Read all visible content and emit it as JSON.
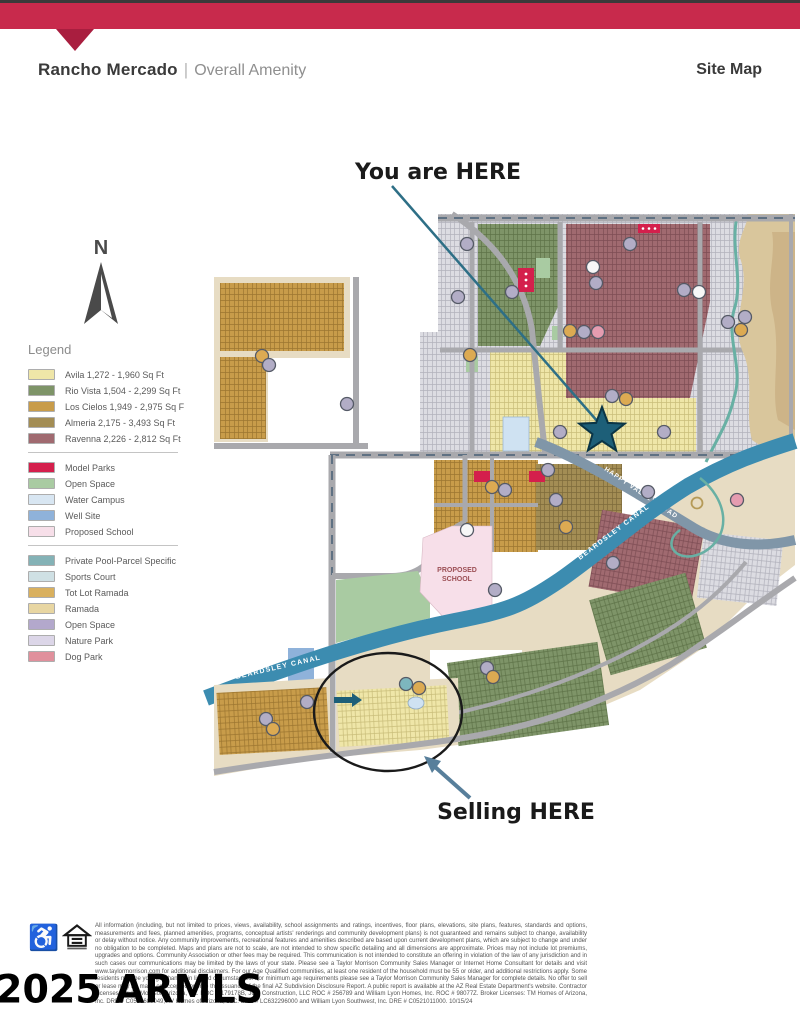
{
  "header": {
    "title": "Rancho Mercado",
    "separator": "|",
    "subtitle": "Overall Amenity",
    "right_label": "Site Map"
  },
  "compass": {
    "label": "N"
  },
  "legend": {
    "title": "Legend",
    "groups": [
      {
        "items": [
          {
            "label": "Avila 1,272 - 1,960 Sq Ft",
            "color": "#efe6a8"
          },
          {
            "label": "Rio Vista 1,504 - 2,299 Sq Ft",
            "color": "#7e9468"
          },
          {
            "label": "Los Cielos 1,949 - 2,975 Sq F",
            "color": "#c89c4a"
          },
          {
            "label": "Almeria 2,175 - 3,493 Sq Ft",
            "color": "#a38d54"
          },
          {
            "label": "Ravenna 2,226 - 2,812 Sq Ft",
            "color": "#a06a70"
          }
        ]
      },
      {
        "items": [
          {
            "label": "Model Parks",
            "color": "#d41f4c"
          },
          {
            "label": "Open Space",
            "color": "#a9cba2"
          },
          {
            "label": "Water Campus",
            "color": "#d8e6f2"
          },
          {
            "label": "Well Site",
            "color": "#8fb2da"
          },
          {
            "label": "Proposed School",
            "color": "#f7dfe9"
          }
        ]
      },
      {
        "items": [
          {
            "label": "Private Pool-Parcel Specific",
            "color": "#84b2b6"
          },
          {
            "label": "Sports Court",
            "color": "#cfe0e4"
          },
          {
            "label": "Tot Lot Ramada",
            "color": "#d9b05e"
          },
          {
            "label": "Ramada",
            "color": "#e8d6a2"
          },
          {
            "label": "Open Space",
            "color": "#b3a8cc"
          },
          {
            "label": "Nature Park",
            "color": "#dcd6e8"
          },
          {
            "label": "Dog Park",
            "color": "#e0909c"
          }
        ]
      }
    ]
  },
  "map": {
    "you_are_here": "You are HERE",
    "selling_here": "Selling HERE",
    "canal_label": "BEARDSLEY CANAL",
    "road_label": "HAPPY VALLEY ROAD",
    "school_line1": "PROPOSED",
    "school_line2": "SCHOOL"
  },
  "footer": {
    "disclaimer": "All information (including, but not limited to prices, views, availability, school assignments and ratings, incentives, floor plans, elevations, site plans, features, standards and options, measurements and fees, planned amenities, programs, conceptual artists' renderings and community development plans) is not guaranteed and remains subject to change, availability or delay without notice. Any community improvements, recreational features and amenities described are based upon current development plans, which are subject to change and under no obligation to be completed. Maps and plans are not to scale, are not intended to show specific detailing and all dimensions are approximate. Prices may not include lot premiums, upgrades and options. Community Association or other fees may be required. This communication is not intended to constitute an offering in violation of the law of any jurisdiction and in such cases our communications may be limited by the laws of your state. Please see a Taylor Morrison Community Sales Manager or Internet Home Consultant for details and visit www.taylormorrison.com for additional disclaimers. For our Age Qualified communities, at least one resident of the household must be 55 or older, and additional restrictions apply. Some residents may be younger than 55 in limited circumstances. For minimum age requirements please see a Taylor Morrison Community Sales Manager for complete details. No offer to sell or lease may be made or accepted prior to the issuance of the final AZ Subdivision Disclosure Report. A public report is available at the AZ Real Estate Department's website. Contractor Licenses: Taylor Morrison/Arizona, Inc. ROC # 179178B, JCH Construction, LLC ROC # 256789 and William Lyon Homes, Inc. ROC # 98077Z. Broker Licenses: TM Homes of Arizona, Inc. DRE # C0536689049, AV Homes of Arizona, LLC. DRE # LC632296000 and William Lyon Southwest, Inc. DRE # C0521011000.  10/15/24",
    "watermark": "2025 ARMLS"
  },
  "palette": {
    "brand_red": "#c82a4c",
    "brand_red_dark": "#a91e3f",
    "avila": "#efe6a8",
    "avila_line": "#c9bd7a",
    "rio": "#7e9468",
    "rio_line": "#5e7348",
    "cielos": "#c89c4a",
    "cielos_line": "#9c7630",
    "almeria": "#a38d54",
    "almeria_line": "#7d6a3a",
    "ravenna": "#a06a70",
    "ravenna_line": "#7d4d54",
    "gray_parcel": "#dcdce2",
    "gray_line": "#b2b2bc",
    "tan_base": "#e7dcc3",
    "tan_deep": "#d9c69c",
    "tan_deeper": "#cdb488",
    "road": "#a9a9ad",
    "road_dash": "#5f7183",
    "canal": "#3c8cb0",
    "hv_road": "#8096a8",
    "open_green": "#a9cba2",
    "school": "#f7dfe9",
    "school_text": "#9c4f55",
    "water_campus": "#cfe2f2",
    "well_site": "#8fb2da",
    "model_park": "#d41f4c",
    "star": "#1d5f78",
    "star_stroke": "#0b3546",
    "arrow_teal": "#2e6f86",
    "arrow_slate": "#587f9b",
    "stream": "#68b0a4",
    "marker_slate": "#b2adc6",
    "marker_gold": "#dcaa52",
    "marker_pink": "#e59cb0",
    "marker_teal": "#7db6be",
    "marker_white": "#f7f7f7",
    "compass_ink": "#4a4a4a",
    "ink": "#1a1a1a"
  }
}
